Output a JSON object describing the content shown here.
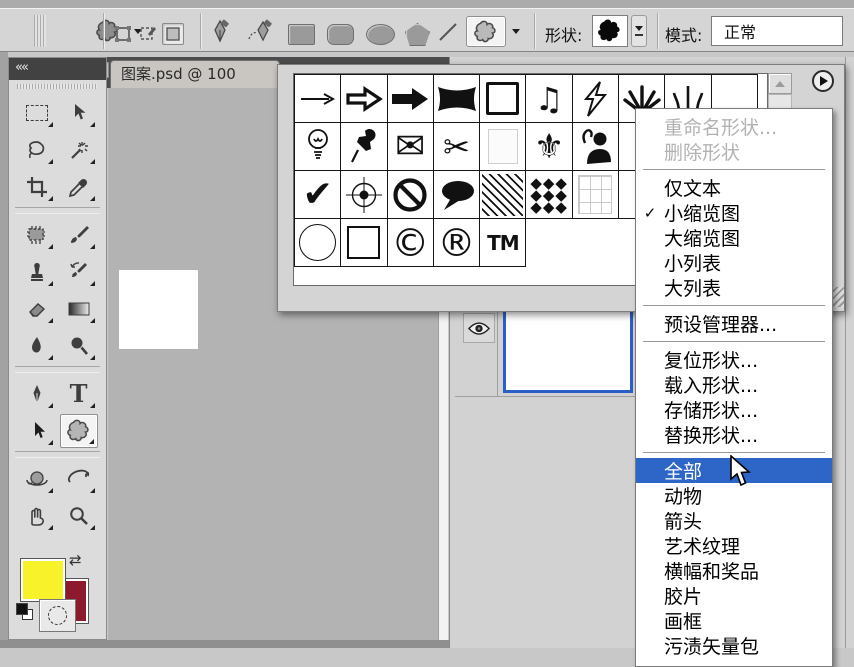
{
  "options_bar": {
    "shape_label": "形状:",
    "mode_label": "模式:",
    "mode_value": "正常",
    "tool_buttons": [
      "tool-preset-picker",
      "shape-layers",
      "paths",
      "fill-pixels",
      "pen",
      "freeform-pen",
      "rectangle",
      "rounded-rectangle",
      "ellipse",
      "polygon",
      "line",
      "custom-shape"
    ]
  },
  "document": {
    "tab_title": "图案.psd @ 100",
    "close_label": "×"
  },
  "toolbox": {
    "collapse_label": "««",
    "selected_tool": "custom-shape",
    "rows": [
      [
        "rectangular-marquee",
        "move"
      ],
      [
        "lasso",
        "magic-wand"
      ],
      [
        "crop",
        "eyedropper"
      ],
      "sep",
      [
        "patch",
        "brush"
      ],
      [
        "clone-stamp",
        "history-brush"
      ],
      [
        "eraser",
        "gradient"
      ],
      [
        "blur",
        "dodge"
      ],
      "sep",
      [
        "pen",
        "type"
      ],
      [
        "path-selection",
        "custom-shape"
      ],
      "sep",
      [
        "rotate-3d",
        "orbit-3d"
      ],
      [
        "hand",
        "zoom"
      ]
    ]
  },
  "colors": {
    "foreground": "#f8f22b",
    "background_swatch": "#8d1a2c",
    "menu_highlight": "#2e66c8",
    "selected_layer_border": "#2b5ec6"
  },
  "shape_picker": {
    "rows": [
      [
        "arrow-thin",
        "arrow-open",
        "arrow-solid",
        "banner",
        "frame",
        "music-notes",
        "lightning",
        "starburst",
        "grass",
        "_empty"
      ],
      [
        "light-bulb",
        "pushpin",
        "envelope",
        "scissors",
        "blank-square",
        "fleur-de-lis",
        "figure-note",
        "_empty",
        "_empty",
        "_empty"
      ],
      [
        "checkmark",
        "registration-target",
        "no-symbol",
        "speech-bubble",
        "diagonal-hatch",
        "diamond-grid",
        "light-grid",
        "_empty",
        "_empty",
        "_empty"
      ],
      [
        "circle",
        "square",
        "copyright",
        "registered",
        "trademark"
      ]
    ]
  },
  "context_menu": {
    "items": [
      {
        "name": "rename-shape",
        "label": "重命名形状...",
        "disabled": true
      },
      {
        "name": "delete-shape",
        "label": "删除形状",
        "disabled": true
      },
      {
        "separator": true
      },
      {
        "name": "text-only",
        "label": "仅文本"
      },
      {
        "name": "small-thumbnail",
        "label": "小缩览图",
        "checked": true
      },
      {
        "name": "large-thumbnail",
        "label": "大缩览图"
      },
      {
        "name": "small-list",
        "label": "小列表"
      },
      {
        "name": "large-list",
        "label": "大列表"
      },
      {
        "separator": true
      },
      {
        "name": "preset-manager",
        "label": "预设管理器..."
      },
      {
        "separator": true
      },
      {
        "name": "reset-shapes",
        "label": "复位形状..."
      },
      {
        "name": "load-shapes",
        "label": "载入形状..."
      },
      {
        "name": "save-shapes",
        "label": "存储形状..."
      },
      {
        "name": "replace-shapes",
        "label": "替换形状..."
      },
      {
        "separator": true
      },
      {
        "name": "all",
        "label": "全部",
        "highlighted": true
      },
      {
        "name": "animals",
        "label": "动物"
      },
      {
        "name": "arrows",
        "label": "箭头"
      },
      {
        "name": "art-textures",
        "label": "艺术纹理"
      },
      {
        "name": "banners-awards",
        "label": "横幅和奖品"
      },
      {
        "name": "film",
        "label": "胶片"
      },
      {
        "name": "frames",
        "label": "画框"
      },
      {
        "name": "grime-vector-pack",
        "label": "污渍矢量包"
      }
    ]
  }
}
